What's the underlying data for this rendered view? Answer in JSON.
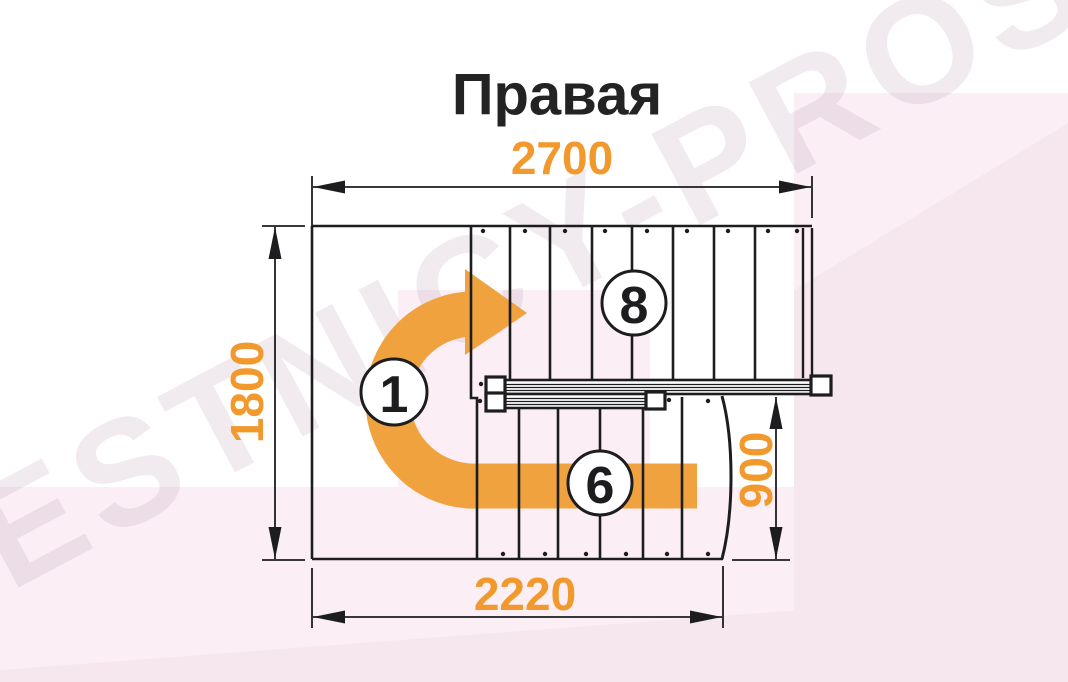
{
  "title": "Правая",
  "watermark": {
    "text": "LESTNICY-PROSTO.RU"
  },
  "dimensions": {
    "top_width": "2700",
    "left_height": "1800",
    "right_height": "900",
    "bottom_width": "2220"
  },
  "labels": {
    "start_step": "1",
    "upper_flight_steps": "8",
    "lower_flight_steps": "6"
  },
  "colors": {
    "accent_orange": "#F2992D",
    "arrow_orange": "#F0A23F",
    "line_black": "#1D1D1F",
    "pink_light": "#FBEFF5",
    "pink_deep": "#F6E7EF",
    "watermark_text": "rgba(186,150,173,0.20)"
  }
}
